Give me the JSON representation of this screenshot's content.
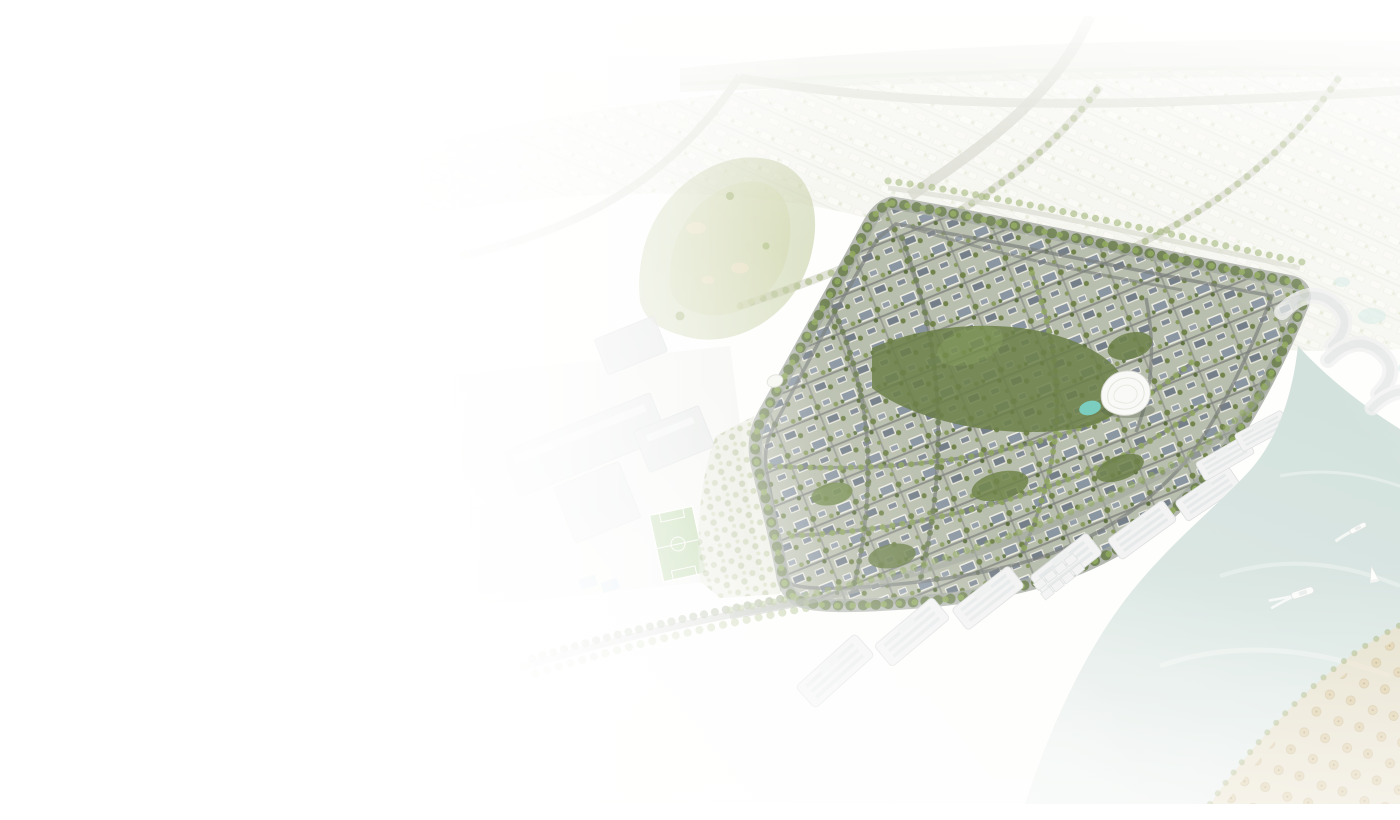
{
  "meta": {
    "description": "Aerial 3D rendering of a master-planned gated villa community with tree-lined streets and a central park with a white shell-shaped pavilion and turquoise pond, bordered by a pale blue-green canal with small boats, white waterfront apartment buildings, curved resort buildings, a beach with umbrella rows, a golf course, a school campus with a soccer field, and faded suburban sprawl; the scene fades into a white background toward the left, top and bottom-left."
  },
  "colors": {
    "background": "#ffffff",
    "haze_warm": "#f6f1e6",
    "water": "#d9e6e4",
    "water_deep": "#cfdfdc",
    "pond": "#6fcdc4",
    "greenery": "#64783c",
    "tree_light": "#84a04e",
    "tree_dark": "#5f7440",
    "golf_green": "#b5c28b",
    "road_gray": "#9aa098",
    "street_dark": "#6f7473",
    "villa_wall": "#ecebe3",
    "villa_roof": "#7e8c9b",
    "building_white": "#f2f3f4",
    "building_line": "#dcdfe1",
    "beach_sand": "#e9dcc0",
    "umbrella_thatch": "#d8c598",
    "campus_gray": "#d8dbdd",
    "field_green": "#8fbc6e",
    "court_blue": "#7fb4d6"
  }
}
